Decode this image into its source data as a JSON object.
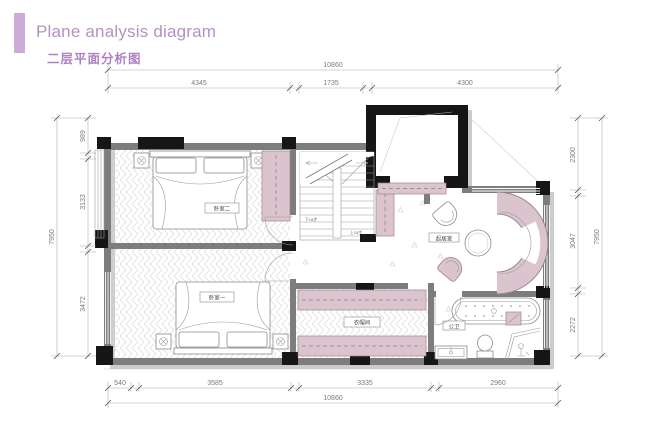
{
  "header": {
    "title": "Plane analysis diagram",
    "subtitle": "二层平面分析图"
  },
  "colors": {
    "accent_bar": "#cdaad8",
    "title_text": "#b78fc6",
    "subtitle_text": "#ad80c2",
    "wall_gray": "#7d7d7d",
    "column_black": "#161616",
    "furniture_pink": "#dcc4cf",
    "dimension_gray": "#7a7a7a"
  },
  "rooms": {
    "bedroom2": {
      "label": "卧室二"
    },
    "bedroom1": {
      "label": "卧室一"
    },
    "closet": {
      "label": "衣帽间"
    },
    "living": {
      "label": "起居室"
    },
    "bath": {
      "label": "公卫"
    }
  },
  "stairs": {
    "down": "下18步",
    "up": "上18步"
  },
  "dimensions": {
    "top": {
      "overall": "10860",
      "segments": [
        "4345",
        "1735",
        "4300"
      ]
    },
    "bottom": {
      "overall": "10860",
      "segments": [
        "540",
        "3585",
        "3335",
        "2960"
      ]
    },
    "left": {
      "overall": "7950",
      "segments": [
        "989",
        "3133",
        "3472"
      ]
    },
    "right": {
      "overall": "7950",
      "segments": [
        "2300",
        "3047",
        "2272"
      ]
    }
  }
}
